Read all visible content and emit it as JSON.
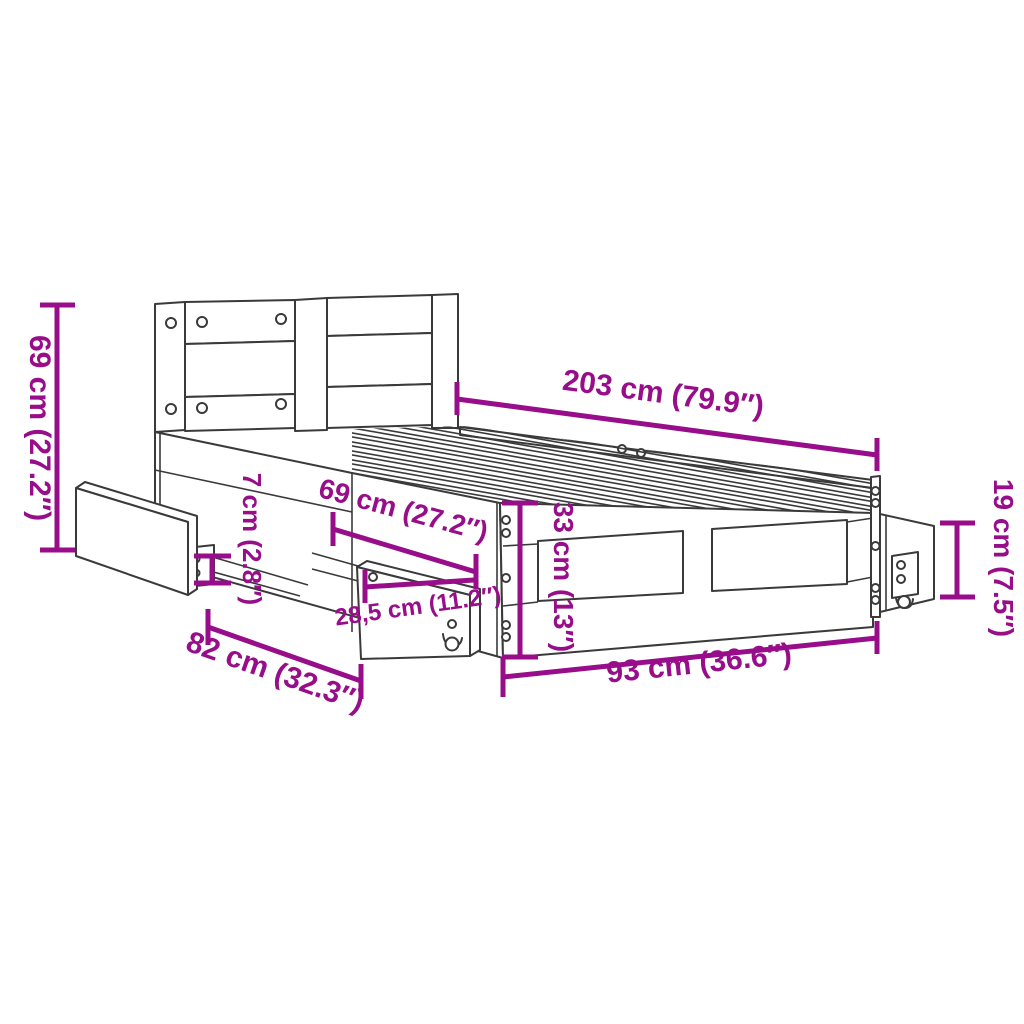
{
  "diagram": {
    "kind": "furniture-dimension-diagram",
    "subject": "bed frame with headboard and pull-out storage drawers",
    "colors": {
      "dimension": "#970D8A",
      "outline": "#3a3a3a",
      "background": "#ffffff"
    },
    "dims": {
      "d69_left": "69 cm (27.2″)",
      "d203": "203 cm (79.9″)",
      "d19": "19 cm (7.5″)",
      "d7": "7 cm (2.8″)",
      "d69_mid": "69 cm (27.2″)",
      "d33": "33 cm (13″)",
      "d285": "28,5 cm (11.2″)",
      "d82": "82 cm (32.3″)",
      "d93": "93 cm (36.6″)"
    }
  }
}
